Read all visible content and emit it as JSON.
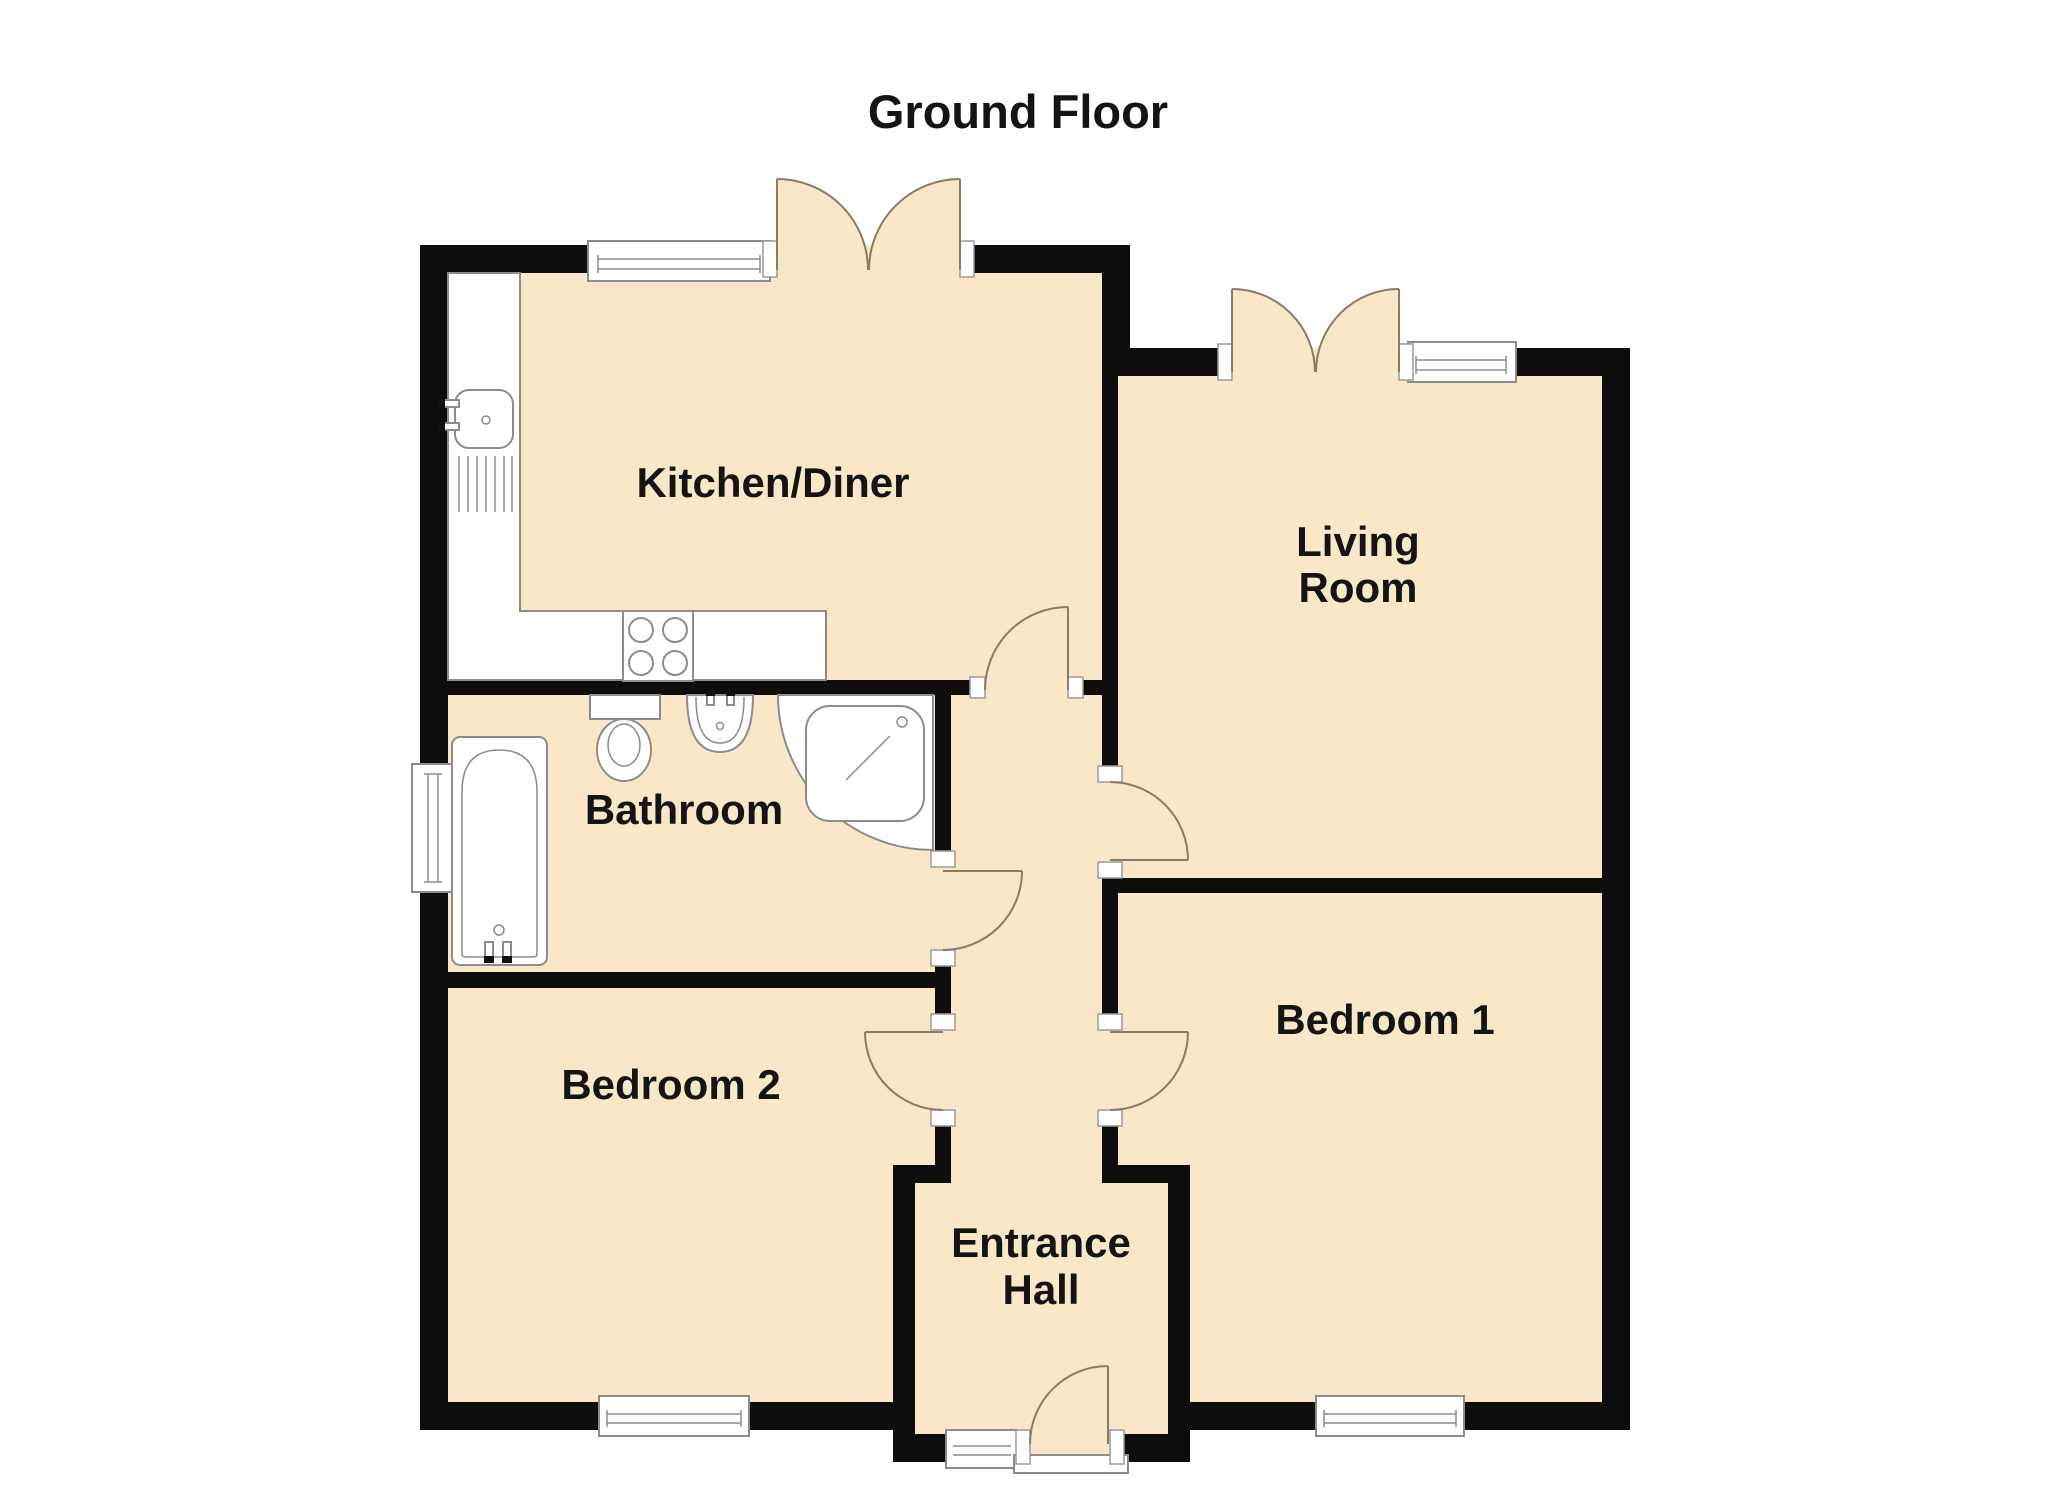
{
  "title": "Ground Floor",
  "rooms": {
    "kitchen": {
      "label": "Kitchen/Diner"
    },
    "living": {
      "lines": [
        "Living",
        "Room"
      ]
    },
    "bathroom": {
      "label": "Bathroom"
    },
    "bedroom1": {
      "label": "Bedroom 1"
    },
    "bedroom2": {
      "label": "Bedroom 2"
    },
    "entrance": {
      "lines": [
        "Entrance",
        "Hall"
      ]
    }
  },
  "colors": {
    "background": "#ffffff",
    "floor": "#fae7c8",
    "wall": "#0d0d0d",
    "door-arc": "#8a7a66",
    "fixture-line": "#8c8c8c",
    "text": "#141414"
  }
}
